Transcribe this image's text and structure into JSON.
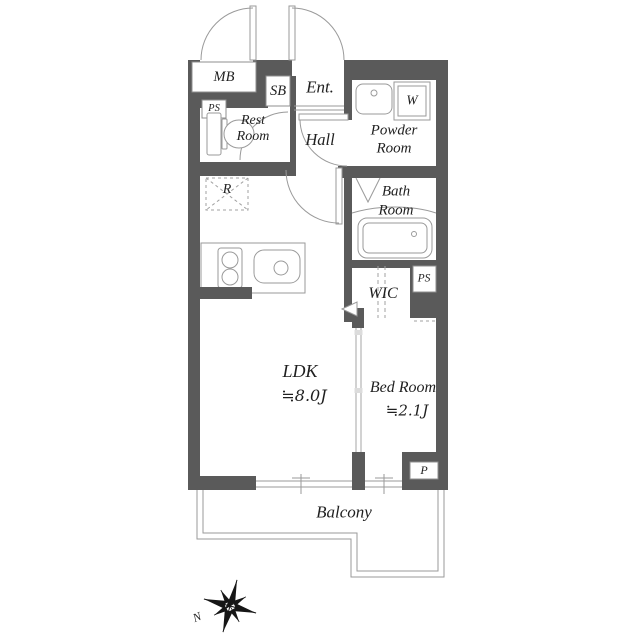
{
  "title": "apartment-floor-plan",
  "colors": {
    "wall": "#5a5a5a",
    "thin_line": "#8f8f8f",
    "text": "#1f1f1f"
  },
  "labels": {
    "mb": "MB",
    "ps_top": "PS",
    "sb": "SB",
    "ent": "Ent.",
    "rest_line1": "Rest",
    "rest_line2": "Room",
    "hall": "Hall",
    "powder_line1": "Powder",
    "powder_line2": "Room",
    "washer": "W",
    "fridge": "R",
    "bath_line1": "Bath",
    "bath_line2": "Room",
    "wic": "WIC",
    "ps_right": "PS",
    "ldk": "LDK",
    "ldk_size": "≒8.0J",
    "bedroom": "Bed Room",
    "bedroom_size": "≒2.1J",
    "p": "P",
    "balcony": "Balcony",
    "compass_north": "N"
  },
  "rooms_summary": [
    {
      "name": "LDK",
      "size": "≒8.0J"
    },
    {
      "name": "Bed Room",
      "size": "≒2.1J"
    }
  ]
}
